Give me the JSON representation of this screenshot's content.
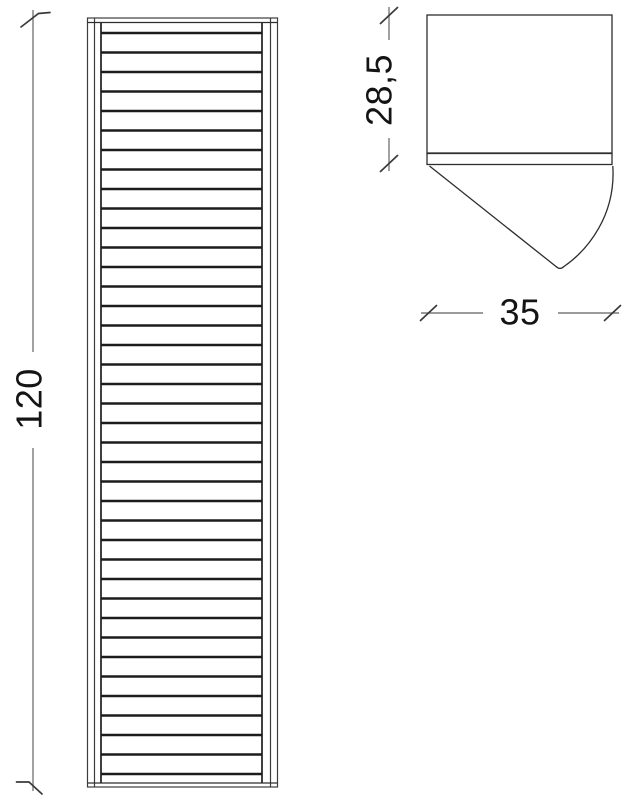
{
  "drawing": {
    "kind": "technical-dimension-drawing",
    "dimensions": {
      "height": {
        "label": "120"
      },
      "depth": {
        "label": "28,5"
      },
      "width": {
        "label": "35"
      }
    },
    "front_view": {
      "slat_count": 39,
      "first_slat_y": 33,
      "slat_pitch": 19.5,
      "slat_x1": 101,
      "slat_x2": 262
    },
    "colors": {
      "background": "#ffffff",
      "outline": "#2e2e2e",
      "slat": "#1c1c1c",
      "dim_line": "#7a7a7a",
      "tick": "#3a3a3a",
      "text": "#141414"
    }
  }
}
